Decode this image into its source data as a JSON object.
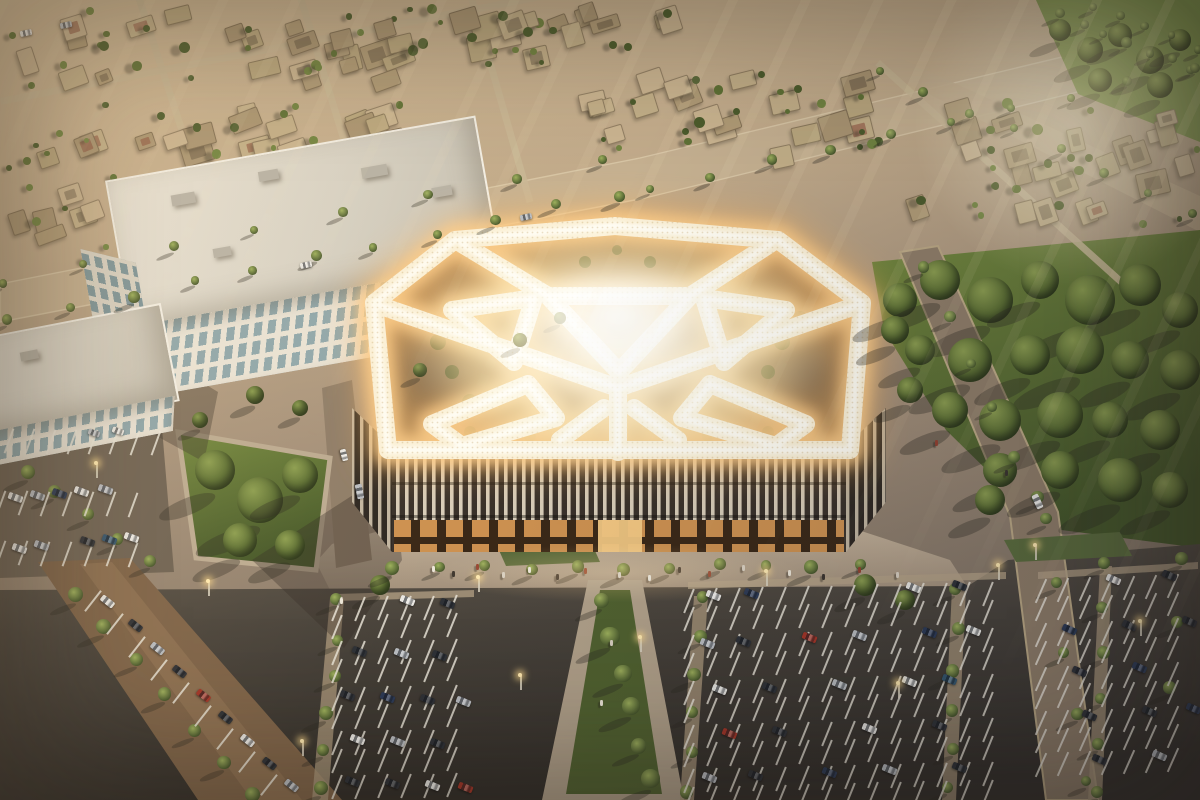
{
  "scene": {
    "type": "aerial-architectural-rendering",
    "time_of_day": "golden-hour"
  },
  "seed": 20240711,
  "palette": {
    "ground_top": "#d2bb97",
    "ground_mid": "#a4907a",
    "ground_low": "#766b5e",
    "road": "#8f7d68",
    "road_sunlit": "#c7b292",
    "paving": "#b3a28a",
    "asphalt_dark": "#37332c",
    "asphalt_mid": "#4a443c",
    "park_green": "#74893f",
    "park_green_dark": "#465829",
    "grass_median": "#50612f",
    "glow_core": "#fffdf4",
    "glow_band": "#fbf1d8",
    "glow_halo": "#ffcf8a",
    "glow_outer": "#ffb85e",
    "facade_fin": "#d8cdb9",
    "facade_glass": "#39312a",
    "storefront_light": "#d99a55",
    "office_wall": "#e9e3d6",
    "office_glass": "#8fa7ac",
    "villa_walls": [
      "#bba87f",
      "#c4b089",
      "#b19c77",
      "#cbb591",
      "#ab9673"
    ],
    "tree_greens": [
      "#5f7135",
      "#718440",
      "#4c5c2c"
    ],
    "cars": {
      "w": "#e9e7e2",
      "s": "#b9bcc0",
      "k": "#2e3136",
      "n": "#2c3a55",
      "r": "#a33527",
      "b": "#33556e",
      "g": "#c9a05a"
    },
    "people": [
      "#ece6d8",
      "#3a342e",
      "#93412f",
      "#d8cfc0"
    ]
  },
  "villas": {
    "bands": [
      [
        8,
        6,
        560,
        88,
        26
      ],
      [
        0,
        100,
        430,
        165,
        18
      ],
      [
        560,
        70,
        880,
        175,
        20
      ],
      [
        880,
        95,
        1200,
        225,
        15
      ],
      [
        300,
        0,
        690,
        46,
        12
      ],
      [
        955,
        140,
        1200,
        225,
        7
      ],
      [
        0,
        170,
        120,
        260,
        6
      ]
    ],
    "streets": [
      [
        0,
        98,
        700,
        -11
      ],
      [
        140,
        -10,
        260,
        72
      ],
      [
        300,
        -16,
        250,
        73
      ],
      [
        470,
        -20,
        230,
        74
      ],
      [
        880,
        60,
        360,
        42
      ]
    ]
  },
  "palm_lines": [
    [
      604,
      600,
      648,
      780,
      6,
      17
    ],
    [
      338,
      600,
      322,
      790,
      6,
      13
    ],
    [
      700,
      598,
      688,
      792,
      6,
      13
    ],
    [
      958,
      588,
      948,
      790,
      6,
      13
    ],
    [
      1105,
      565,
      1095,
      790,
      6,
      12
    ],
    [
      1180,
      558,
      1172,
      690,
      3,
      11
    ],
    [
      75,
      595,
      255,
      795,
      7,
      15
    ],
    [
      25,
      470,
      150,
      560,
      5,
      13
    ],
    [
      390,
      568,
      860,
      566,
      11,
      12
    ],
    [
      10,
      322,
      620,
      194,
      11,
      10
    ],
    [
      650,
      188,
      1190,
      70,
      10,
      9
    ],
    [
      0,
      285,
      600,
      160,
      8,
      9
    ],
    [
      925,
      270,
      1040,
      500,
      6,
      11
    ],
    [
      1045,
      520,
      1085,
      780,
      5,
      12
    ],
    [
      1060,
      15,
      1195,
      70,
      7,
      9
    ],
    [
      1090,
      6,
      1200,
      48,
      5,
      8
    ],
    [
      880,
      70,
      1195,
      212,
      8,
      9
    ]
  ],
  "tree_clumps": [
    [
      900,
      300,
      34
    ],
    [
      940,
      280,
      40
    ],
    [
      990,
      300,
      46
    ],
    [
      1040,
      280,
      38
    ],
    [
      1090,
      300,
      50
    ],
    [
      1140,
      285,
      42
    ],
    [
      1180,
      310,
      36
    ],
    [
      920,
      350,
      30
    ],
    [
      970,
      360,
      44
    ],
    [
      1030,
      355,
      40
    ],
    [
      1080,
      350,
      48
    ],
    [
      1130,
      360,
      38
    ],
    [
      1180,
      370,
      40
    ],
    [
      950,
      410,
      36
    ],
    [
      1000,
      420,
      42
    ],
    [
      1060,
      415,
      46
    ],
    [
      1110,
      420,
      36
    ],
    [
      1160,
      430,
      40
    ],
    [
      1000,
      470,
      34
    ],
    [
      1060,
      470,
      38
    ],
    [
      1120,
      480,
      44
    ],
    [
      1170,
      490,
      36
    ],
    [
      990,
      500,
      30
    ],
    [
      895,
      330,
      28
    ],
    [
      910,
      390,
      26
    ],
    [
      215,
      470,
      40
    ],
    [
      260,
      500,
      46
    ],
    [
      300,
      475,
      36
    ],
    [
      240,
      540,
      34
    ],
    [
      290,
      545,
      30
    ],
    [
      255,
      395,
      18
    ],
    [
      300,
      408,
      16
    ],
    [
      420,
      370,
      14
    ],
    [
      520,
      340,
      14
    ],
    [
      560,
      318,
      12
    ],
    [
      200,
      420,
      16
    ],
    [
      380,
      585,
      20
    ],
    [
      865,
      585,
      22
    ],
    [
      905,
      600,
      20
    ],
    [
      1060,
      30,
      22
    ],
    [
      1090,
      50,
      26
    ],
    [
      1120,
      35,
      24
    ],
    [
      1150,
      60,
      28
    ],
    [
      1180,
      40,
      22
    ],
    [
      1100,
      80,
      24
    ],
    [
      1160,
      85,
      26
    ]
  ],
  "garden_blobs": [
    [
      420,
      318,
      7
    ],
    [
      438,
      342,
      8
    ],
    [
      452,
      372,
      7
    ],
    [
      470,
      402,
      8
    ],
    [
      800,
      318,
      7
    ],
    [
      782,
      342,
      8
    ],
    [
      768,
      372,
      7
    ],
    [
      750,
      402,
      8
    ],
    [
      470,
      432,
      6
    ],
    [
      500,
      442,
      7
    ],
    [
      530,
      436,
      6
    ],
    [
      768,
      432,
      6
    ],
    [
      738,
      442,
      7
    ],
    [
      708,
      436,
      6
    ],
    [
      585,
      262,
      6
    ],
    [
      650,
      262,
      6
    ],
    [
      617,
      250,
      5
    ]
  ],
  "stripe_rows": [
    [
      336,
      596,
      6,
      23,
      -0.35,
      22
    ],
    [
      336,
      614,
      6,
      23,
      -0.35,
      22
    ],
    [
      336,
      640,
      6,
      23,
      -0.35,
      22
    ],
    [
      336,
      658,
      6,
      23,
      -0.35,
      22
    ],
    [
      336,
      686,
      6,
      23,
      -0.35,
      22
    ],
    [
      336,
      704,
      6,
      23,
      -0.35,
      22
    ],
    [
      336,
      730,
      6,
      23,
      -0.35,
      22
    ],
    [
      336,
      748,
      6,
      23,
      -0.35,
      22
    ],
    [
      336,
      774,
      6,
      23,
      -0.35,
      22
    ],
    [
      688,
      588,
      14,
      23,
      -0.57,
      22
    ],
    [
      688,
      606,
      14,
      23,
      -0.57,
      22
    ],
    [
      688,
      634,
      14,
      23,
      -0.57,
      22
    ],
    [
      688,
      652,
      14,
      23,
      -0.57,
      22
    ],
    [
      688,
      680,
      14,
      23,
      -0.57,
      22
    ],
    [
      688,
      698,
      14,
      23,
      -0.57,
      22
    ],
    [
      688,
      724,
      14,
      23,
      -0.57,
      22
    ],
    [
      688,
      742,
      14,
      23,
      -0.57,
      22
    ],
    [
      688,
      768,
      14,
      23,
      -0.57,
      22
    ],
    [
      688,
      786,
      14,
      23,
      -0.57,
      22
    ],
    [
      1040,
      578,
      7,
      22,
      -0.8,
      24
    ],
    [
      1040,
      596,
      7,
      22,
      -0.8,
      24
    ],
    [
      1040,
      622,
      7,
      22,
      -0.8,
      24
    ],
    [
      1040,
      640,
      7,
      22,
      -0.8,
      24
    ],
    [
      1040,
      666,
      7,
      22,
      -0.8,
      24
    ],
    [
      1040,
      684,
      7,
      22,
      -0.8,
      24
    ],
    [
      1040,
      710,
      7,
      22,
      -0.8,
      24
    ],
    [
      1040,
      728,
      7,
      22,
      -0.8,
      24
    ],
    [
      1040,
      752,
      7,
      22,
      -0.8,
      24
    ],
    [
      8,
      428,
      8,
      21,
      0.25,
      20
    ],
    [
      0,
      490,
      7,
      22,
      0.25,
      20
    ],
    [
      0,
      540,
      7,
      22,
      0.25,
      20
    ],
    [
      92,
      588,
      9,
      22,
      23,
      38
    ]
  ],
  "cars": [
    [
      100,
      598,
      38,
      "w"
    ],
    [
      128,
      622,
      38,
      "k"
    ],
    [
      150,
      645,
      38,
      "s"
    ],
    [
      172,
      668,
      38,
      "k"
    ],
    [
      196,
      692,
      38,
      "r"
    ],
    [
      218,
      714,
      38,
      "k"
    ],
    [
      240,
      737,
      38,
      "w"
    ],
    [
      262,
      760,
      38,
      "k"
    ],
    [
      284,
      782,
      38,
      "s"
    ],
    [
      88,
      430,
      20,
      "s"
    ],
    [
      112,
      428,
      20,
      "w"
    ],
    [
      8,
      494,
      20,
      "w"
    ],
    [
      30,
      492,
      20,
      "s"
    ],
    [
      52,
      490,
      20,
      "n"
    ],
    [
      74,
      488,
      20,
      "w"
    ],
    [
      98,
      486,
      20,
      "s"
    ],
    [
      12,
      545,
      20,
      "w"
    ],
    [
      34,
      542,
      20,
      "s"
    ],
    [
      80,
      538,
      20,
      "k"
    ],
    [
      102,
      536,
      20,
      "b"
    ],
    [
      124,
      534,
      20,
      "w"
    ],
    [
      400,
      597,
      22,
      "w"
    ],
    [
      440,
      600,
      22,
      "k"
    ],
    [
      352,
      648,
      22,
      "k"
    ],
    [
      394,
      650,
      22,
      "s"
    ],
    [
      432,
      652,
      22,
      "k"
    ],
    [
      340,
      692,
      22,
      "k"
    ],
    [
      380,
      694,
      22,
      "n"
    ],
    [
      420,
      696,
      22,
      "k"
    ],
    [
      456,
      698,
      22,
      "s"
    ],
    [
      350,
      736,
      22,
      "w"
    ],
    [
      390,
      738,
      22,
      "s"
    ],
    [
      430,
      740,
      22,
      "k"
    ],
    [
      345,
      778,
      22,
      "k"
    ],
    [
      385,
      780,
      22,
      "k"
    ],
    [
      425,
      782,
      22,
      "w"
    ],
    [
      458,
      784,
      22,
      "r"
    ],
    [
      706,
      592,
      22,
      "w"
    ],
    [
      744,
      590,
      22,
      "n"
    ],
    [
      906,
      584,
      22,
      "w"
    ],
    [
      952,
      582,
      22,
      "k"
    ],
    [
      700,
      640,
      22,
      "s"
    ],
    [
      736,
      638,
      22,
      "k"
    ],
    [
      802,
      634,
      22,
      "r"
    ],
    [
      852,
      632,
      22,
      "s"
    ],
    [
      922,
      629,
      22,
      "n"
    ],
    [
      966,
      627,
      22,
      "w"
    ],
    [
      712,
      686,
      22,
      "w"
    ],
    [
      762,
      684,
      22,
      "k"
    ],
    [
      832,
      681,
      22,
      "s"
    ],
    [
      902,
      678,
      22,
      "w"
    ],
    [
      942,
      676,
      22,
      "b"
    ],
    [
      722,
      730,
      22,
      "r"
    ],
    [
      772,
      728,
      22,
      "k"
    ],
    [
      862,
      725,
      22,
      "w"
    ],
    [
      932,
      722,
      22,
      "k"
    ],
    [
      702,
      774,
      22,
      "s"
    ],
    [
      748,
      772,
      22,
      "k"
    ],
    [
      822,
      769,
      22,
      "n"
    ],
    [
      882,
      766,
      22,
      "s"
    ],
    [
      952,
      764,
      22,
      "k"
    ],
    [
      1106,
      576,
      24,
      "w"
    ],
    [
      1162,
      572,
      24,
      "k"
    ],
    [
      1062,
      626,
      24,
      "n"
    ],
    [
      1122,
      622,
      24,
      "k"
    ],
    [
      1182,
      618,
      24,
      "k"
    ],
    [
      1072,
      668,
      24,
      "k"
    ],
    [
      1132,
      664,
      24,
      "n"
    ],
    [
      1082,
      712,
      24,
      "k"
    ],
    [
      1142,
      708,
      24,
      "k"
    ],
    [
      1186,
      705,
      24,
      "n"
    ],
    [
      1092,
      756,
      24,
      "k"
    ],
    [
      1152,
      752,
      24,
      "s"
    ],
    [
      1030,
      498,
      65,
      "w"
    ],
    [
      338,
      452,
      75,
      "w"
    ],
    [
      352,
      488,
      78,
      "s"
    ],
    [
      520,
      214,
      -12,
      "s"
    ],
    [
      300,
      262,
      -12,
      "w"
    ],
    [
      20,
      30,
      -12,
      "w"
    ],
    [
      60,
      22,
      -12,
      "s"
    ]
  ],
  "people": [
    [
      432,
      566
    ],
    [
      452,
      571
    ],
    [
      476,
      564
    ],
    [
      502,
      572
    ],
    [
      528,
      567
    ],
    [
      556,
      574
    ],
    [
      584,
      568
    ],
    [
      618,
      572
    ],
    [
      648,
      575
    ],
    [
      678,
      567
    ],
    [
      708,
      571
    ],
    [
      742,
      565
    ],
    [
      788,
      570
    ],
    [
      822,
      574
    ],
    [
      858,
      567
    ],
    [
      896,
      572
    ],
    [
      340,
      598
    ],
    [
      1005,
      470
    ],
    [
      935,
      440
    ],
    [
      610,
      640
    ],
    [
      600,
      700
    ]
  ],
  "lamps": [
    [
      208,
      596
    ],
    [
      478,
      592
    ],
    [
      766,
      586
    ],
    [
      998,
      580
    ],
    [
      1140,
      636
    ],
    [
      96,
      478
    ],
    [
      302,
      756
    ],
    [
      898,
      698
    ],
    [
      520,
      690
    ],
    [
      640,
      652
    ],
    [
      1035,
      560
    ]
  ]
}
